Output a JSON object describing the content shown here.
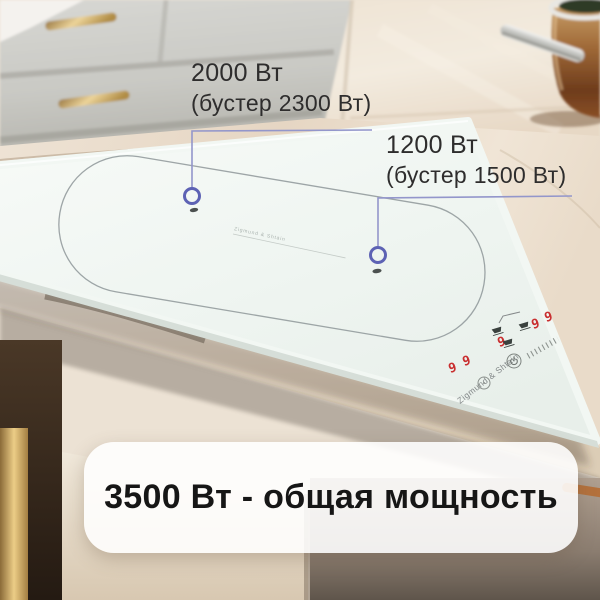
{
  "callouts": {
    "left": {
      "power": "2000 Вт",
      "booster": "(бустер 2300 Вт)"
    },
    "right": {
      "power": "1200 Вт",
      "booster": "(бустер 1500 Вт)"
    }
  },
  "banner": {
    "text": "3500 Вт - общая мощность"
  },
  "cooktop": {
    "brand": "Zigmund & Shtain",
    "displays": [
      "9",
      "9",
      "9",
      "9",
      "9"
    ]
  },
  "colors": {
    "callout_line": "#9396cb",
    "callout_ring": "#5d62b4",
    "digit_red": "#c92f30",
    "banner_bg": "rgba(255,255,255,0.88)",
    "hob_glass": "#f3f8f4",
    "gold_handle": "#d9b878",
    "copper_pot": "#a06a38"
  }
}
